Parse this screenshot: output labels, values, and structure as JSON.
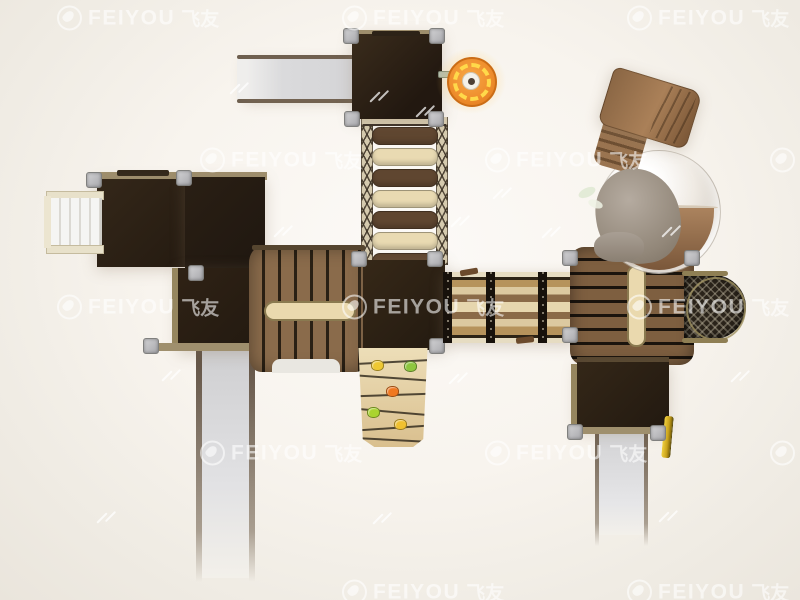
{
  "scene": {
    "description": "Top-down 3D render of a children's wooden playground set",
    "background_center": "#fcfaf7",
    "background_edge": "#eae5dc"
  },
  "watermark": {
    "brand_latin": "FEIYOU",
    "brand_cjk": "飞友",
    "text_color": "#ffffff",
    "opacity": 0.58,
    "positions": [
      {
        "x": 57,
        "y": 18
      },
      {
        "x": 342,
        "y": 18
      },
      {
        "x": 627,
        "y": 18
      },
      {
        "x": 200,
        "y": 160
      },
      {
        "x": 485,
        "y": 160
      },
      {
        "x": 770,
        "y": 160
      },
      {
        "x": 57,
        "y": 307
      },
      {
        "x": 342,
        "y": 307
      },
      {
        "x": 627,
        "y": 307
      },
      {
        "x": 200,
        "y": 453
      },
      {
        "x": 485,
        "y": 453
      },
      {
        "x": 770,
        "y": 453
      },
      {
        "x": 342,
        "y": 592
      },
      {
        "x": 627,
        "y": 592
      }
    ],
    "dash_marks": [
      [
        228,
        88
      ],
      [
        368,
        96
      ],
      [
        414,
        111
      ],
      [
        449,
        221
      ],
      [
        491,
        193
      ],
      [
        272,
        231
      ],
      [
        540,
        232
      ],
      [
        660,
        231
      ],
      [
        160,
        375
      ],
      [
        447,
        378
      ],
      [
        729,
        376
      ],
      [
        95,
        517
      ],
      [
        371,
        518
      ],
      [
        657,
        516
      ]
    ]
  },
  "colors": {
    "dark_platform": "#2b2014",
    "wood_plank": "#8a6b4b",
    "plank_gap": "#241b10",
    "light_wood": "#e9dab2",
    "trim_tan": "#9f8f6d",
    "slide_surface": "#d8d8da",
    "slide_rail": "#6e5f4f",
    "stairs_white": "#f5f5f3",
    "spinner_orange": "#ef8f2e",
    "spinner_yellow": "#ffd94a",
    "tube_brown": "#9a7452",
    "tube_gray": "#9a8d82",
    "dome_clear": "#e8e3dc",
    "mesh_black": "#2a231a",
    "handle_yellow": "#e8c830",
    "metal_post": "#c2c2c4"
  },
  "components": {
    "rope_bridge": {
      "name": "rope bridge",
      "plank_colors": [
        "#5f4630",
        "#e9dab2",
        "#5f4630",
        "#e9dab2",
        "#5f4630",
        "#e9dab2",
        "#5f4630"
      ]
    },
    "climbing_wall": {
      "name": "climbing wall",
      "holds": [
        {
          "x": 371,
          "y": 360,
          "color": "#eec832"
        },
        {
          "x": 404,
          "y": 361,
          "color": "#8ec63f"
        },
        {
          "x": 386,
          "y": 386,
          "color": "#f07820"
        },
        {
          "x": 367,
          "y": 407,
          "color": "#aad42f"
        },
        {
          "x": 394,
          "y": 419,
          "color": "#f0c030"
        }
      ]
    },
    "plank_walkway": {
      "name": "plank walkway",
      "bar_positions": [
        443,
        486,
        538
      ]
    },
    "slides": {
      "name": "straight slides",
      "count": 3,
      "color": "#d8d8da"
    },
    "spinner": {
      "name": "steering wheel spinner"
    },
    "tube_slide": {
      "name": "tube slide with clear dome"
    },
    "mesh_ball": {
      "name": "climbing mesh dome"
    },
    "stairs": {
      "name": "entry steps"
    }
  }
}
